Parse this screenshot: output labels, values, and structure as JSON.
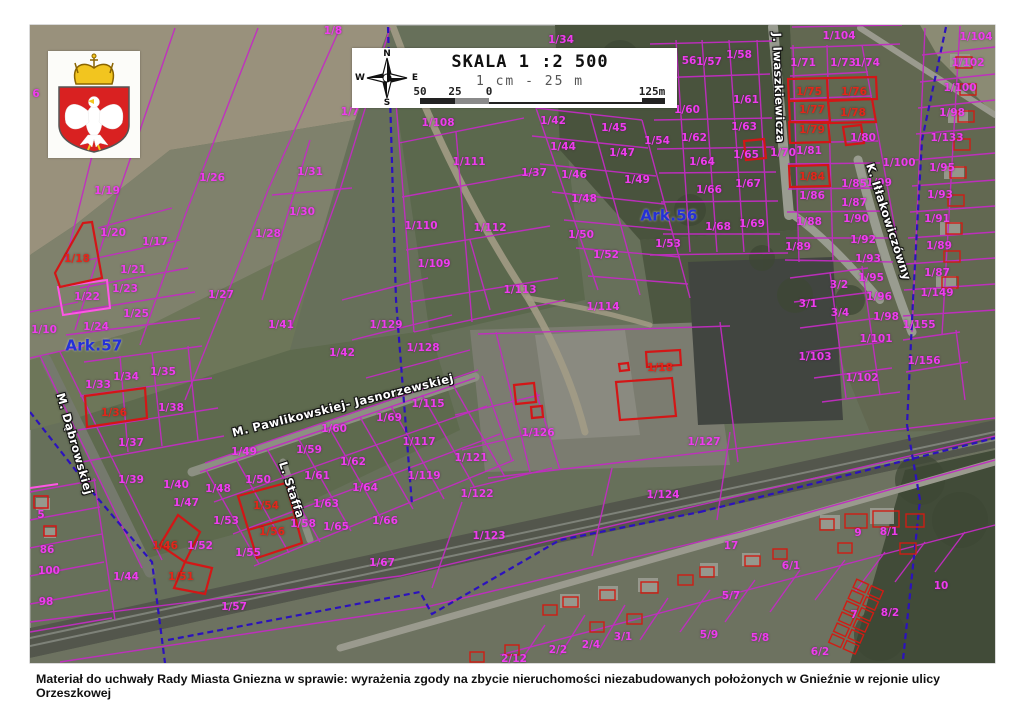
{
  "caption": "Materiał do uchwały Rady Miasta Gniezna w sprawie: wyrażenia zgody na zbycie nieruchomości niezabudowanych położonych w Gnieźnie w rejonie ulicy Orzeszkowej",
  "scale_box": {
    "title": "SKALA 1 :2 500",
    "subtitle": "1 cm - 25 m",
    "compass": {
      "n": "N",
      "e": "E",
      "s": "S",
      "w": "W"
    },
    "bar_labels": [
      {
        "t": "50",
        "x": 0
      },
      {
        "t": "25",
        "x": 35
      },
      {
        "t": "0",
        "x": 69
      },
      {
        "t": "125m",
        "x": 232
      }
    ]
  },
  "colors": {
    "parcel_line_magenta": "#c22cc2",
    "parcel_label_magenta": "#ee3cee",
    "highlight_red": "#d31616",
    "sheet_label_blue": "#2430d8",
    "sheet_boundary_blue": "#2c12bd"
  },
  "highlighted_parcels": [
    "1/18",
    "1/36",
    "1/46",
    "1/51",
    "1/54",
    "1/56",
    "1/75",
    "1/76",
    "1/77",
    "1/78",
    "1/79",
    "1/84"
  ],
  "map": {
    "sheets": [
      "Ark.57",
      "Ark.56"
    ],
    "streets": [
      "M. Dąbrowskiej",
      "M. Pawlikowskiej- Jasnorzewskiej",
      "L. Staffa",
      "J. Iwaszkiewicza",
      "K. Iłłakowiczówny"
    ],
    "labels": [
      {
        "t": "1/8",
        "x": 333,
        "y": 31
      },
      {
        "t": "6",
        "x": 36,
        "y": 94
      },
      {
        "t": "1/7",
        "x": 350,
        "y": 112
      },
      {
        "t": "1/19",
        "x": 107,
        "y": 191
      },
      {
        "t": "1/26",
        "x": 212,
        "y": 178
      },
      {
        "t": "1/31",
        "x": 310,
        "y": 172
      },
      {
        "t": "1/30",
        "x": 302,
        "y": 212
      },
      {
        "t": "1/28",
        "x": 268,
        "y": 234
      },
      {
        "t": "1/17",
        "x": 155,
        "y": 242
      },
      {
        "t": "1/20",
        "x": 113,
        "y": 233
      },
      {
        "t": "1/18",
        "x": 77,
        "y": 259,
        "c": "r"
      },
      {
        "t": "1/21",
        "x": 133,
        "y": 270
      },
      {
        "t": "1/23",
        "x": 125,
        "y": 289
      },
      {
        "t": "1/22",
        "x": 87,
        "y": 297
      },
      {
        "t": "1/27",
        "x": 221,
        "y": 295
      },
      {
        "t": "1/25",
        "x": 136,
        "y": 314
      },
      {
        "t": "1/24",
        "x": 96,
        "y": 327
      },
      {
        "t": "1/10",
        "x": 44,
        "y": 330
      },
      {
        "t": "Ark.57",
        "x": 94,
        "y": 346,
        "c": "b"
      },
      {
        "t": "1/33",
        "x": 98,
        "y": 385
      },
      {
        "t": "1/34",
        "x": 126,
        "y": 377
      },
      {
        "t": "1/35",
        "x": 163,
        "y": 372
      },
      {
        "t": "1/36",
        "x": 114,
        "y": 413,
        "c": "r"
      },
      {
        "t": "1/38",
        "x": 171,
        "y": 408
      },
      {
        "t": "1/37",
        "x": 131,
        "y": 443
      },
      {
        "t": "1/41",
        "x": 281,
        "y": 325
      },
      {
        "t": "1/42",
        "x": 342,
        "y": 353
      },
      {
        "t": "1/39",
        "x": 131,
        "y": 480
      },
      {
        "t": "1/40",
        "x": 176,
        "y": 485
      },
      {
        "t": "1/49",
        "x": 244,
        "y": 452
      },
      {
        "t": "1/48",
        "x": 218,
        "y": 489
      },
      {
        "t": "1/50",
        "x": 258,
        "y": 480
      },
      {
        "t": "1/53",
        "x": 226,
        "y": 521
      },
      {
        "t": "1/54",
        "x": 266,
        "y": 506,
        "c": "r"
      },
      {
        "t": "1/56",
        "x": 272,
        "y": 532,
        "c": "r"
      },
      {
        "t": "1/55",
        "x": 248,
        "y": 553
      },
      {
        "t": "1/58",
        "x": 303,
        "y": 524
      },
      {
        "t": "1/59",
        "x": 309,
        "y": 450
      },
      {
        "t": "1/60",
        "x": 334,
        "y": 429
      },
      {
        "t": "1/61",
        "x": 317,
        "y": 476
      },
      {
        "t": "1/62",
        "x": 353,
        "y": 462
      },
      {
        "t": "1/63",
        "x": 326,
        "y": 504
      },
      {
        "t": "1/64",
        "x": 365,
        "y": 488
      },
      {
        "t": "1/65",
        "x": 336,
        "y": 527
      },
      {
        "t": "1/66",
        "x": 385,
        "y": 521
      },
      {
        "t": "1/67",
        "x": 382,
        "y": 563
      },
      {
        "t": "1/69",
        "x": 389,
        "y": 418
      },
      {
        "t": "1/115",
        "x": 428,
        "y": 404
      },
      {
        "t": "1/117",
        "x": 419,
        "y": 442
      },
      {
        "t": "1/119",
        "x": 424,
        "y": 476
      },
      {
        "t": "1/121",
        "x": 471,
        "y": 458
      },
      {
        "t": "1/122",
        "x": 477,
        "y": 494
      },
      {
        "t": "1/129",
        "x": 386,
        "y": 325
      },
      {
        "t": "1/128",
        "x": 423,
        "y": 348
      },
      {
        "t": "5",
        "x": 41,
        "y": 515
      },
      {
        "t": "86",
        "x": 47,
        "y": 550
      },
      {
        "t": "100",
        "x": 49,
        "y": 571
      },
      {
        "t": "98",
        "x": 46,
        "y": 602
      },
      {
        "t": "1/44",
        "x": 126,
        "y": 577
      },
      {
        "t": "1/47",
        "x": 186,
        "y": 503
      },
      {
        "t": "1/46",
        "x": 165,
        "y": 546,
        "c": "r"
      },
      {
        "t": "1/52",
        "x": 200,
        "y": 546
      },
      {
        "t": "1/51",
        "x": 181,
        "y": 577,
        "c": "r"
      },
      {
        "t": "1/57",
        "x": 234,
        "y": 607
      },
      {
        "t": "1/34",
        "x": 561,
        "y": 40
      },
      {
        "t": "1/108",
        "x": 438,
        "y": 123
      },
      {
        "t": "1/42",
        "x": 553,
        "y": 121
      },
      {
        "t": "1/45",
        "x": 614,
        "y": 128
      },
      {
        "t": "1/111",
        "x": 469,
        "y": 162
      },
      {
        "t": "1/44",
        "x": 563,
        "y": 147
      },
      {
        "t": "1/47",
        "x": 622,
        "y": 153
      },
      {
        "t": "1/37",
        "x": 534,
        "y": 173
      },
      {
        "t": "1/46",
        "x": 574,
        "y": 175
      },
      {
        "t": "1/49",
        "x": 637,
        "y": 180
      },
      {
        "t": "1/110",
        "x": 421,
        "y": 226
      },
      {
        "t": "1/48",
        "x": 584,
        "y": 199
      },
      {
        "t": "1/112",
        "x": 490,
        "y": 228
      },
      {
        "t": "1/50",
        "x": 581,
        "y": 235
      },
      {
        "t": "1/109",
        "x": 434,
        "y": 264
      },
      {
        "t": "1/52",
        "x": 606,
        "y": 255
      },
      {
        "t": "1/113",
        "x": 520,
        "y": 290
      },
      {
        "t": "1/114",
        "x": 603,
        "y": 307
      },
      {
        "t": "Ark.56",
        "x": 669,
        "y": 216,
        "c": "b"
      },
      {
        "t": "56",
        "x": 689,
        "y": 61
      },
      {
        "t": "1/57",
        "x": 709,
        "y": 62
      },
      {
        "t": "1/58",
        "x": 739,
        "y": 55
      },
      {
        "t": "1/61",
        "x": 746,
        "y": 100
      },
      {
        "t": "1/60",
        "x": 687,
        "y": 110
      },
      {
        "t": "1/63",
        "x": 744,
        "y": 127
      },
      {
        "t": "1/62",
        "x": 694,
        "y": 138
      },
      {
        "t": "1/54",
        "x": 657,
        "y": 141
      },
      {
        "t": "1/65",
        "x": 746,
        "y": 155
      },
      {
        "t": "1/64",
        "x": 702,
        "y": 162
      },
      {
        "t": "1/67",
        "x": 748,
        "y": 184
      },
      {
        "t": "1/66",
        "x": 709,
        "y": 190
      },
      {
        "t": "1/53",
        "x": 668,
        "y": 244
      },
      {
        "t": "1/68",
        "x": 718,
        "y": 227
      },
      {
        "t": "1/69",
        "x": 752,
        "y": 224
      },
      {
        "t": "1/70",
        "x": 783,
        "y": 153
      },
      {
        "t": "1/104",
        "x": 839,
        "y": 36
      },
      {
        "t": "1/71",
        "x": 803,
        "y": 63
      },
      {
        "t": "1/73",
        "x": 843,
        "y": 63
      },
      {
        "t": "1/74",
        "x": 867,
        "y": 63
      },
      {
        "t": "1/75",
        "x": 809,
        "y": 92,
        "c": "r"
      },
      {
        "t": "1/76",
        "x": 854,
        "y": 92,
        "c": "r"
      },
      {
        "t": "1/77",
        "x": 812,
        "y": 110,
        "c": "r"
      },
      {
        "t": "1/78",
        "x": 853,
        "y": 113,
        "c": "r"
      },
      {
        "t": "1/79",
        "x": 812,
        "y": 130,
        "c": "r"
      },
      {
        "t": "1/80",
        "x": 863,
        "y": 138
      },
      {
        "t": "1/81",
        "x": 809,
        "y": 151
      },
      {
        "t": "1/84",
        "x": 812,
        "y": 177,
        "c": "r"
      },
      {
        "t": "1/100",
        "x": 899,
        "y": 163
      },
      {
        "t": "1/99",
        "x": 879,
        "y": 183
      },
      {
        "t": "1/85",
        "x": 854,
        "y": 184
      },
      {
        "t": "1/86",
        "x": 812,
        "y": 196
      },
      {
        "t": "1/87",
        "x": 854,
        "y": 203
      },
      {
        "t": "1/88",
        "x": 809,
        "y": 222
      },
      {
        "t": "1/90",
        "x": 856,
        "y": 219
      },
      {
        "t": "1/89",
        "x": 798,
        "y": 247
      },
      {
        "t": "1/92",
        "x": 863,
        "y": 240
      },
      {
        "t": "1/93",
        "x": 868,
        "y": 259
      },
      {
        "t": "3/2",
        "x": 839,
        "y": 285
      },
      {
        "t": "1/95",
        "x": 871,
        "y": 278
      },
      {
        "t": "3/1",
        "x": 808,
        "y": 304
      },
      {
        "t": "1/96",
        "x": 879,
        "y": 297
      },
      {
        "t": "3/4",
        "x": 840,
        "y": 313
      },
      {
        "t": "1/98",
        "x": 886,
        "y": 317
      },
      {
        "t": "1/101",
        "x": 876,
        "y": 339
      },
      {
        "t": "1/103",
        "x": 815,
        "y": 357
      },
      {
        "t": "1/102",
        "x": 862,
        "y": 378
      },
      {
        "t": "1/104",
        "x": 976,
        "y": 37
      },
      {
        "t": "1/102",
        "x": 968,
        "y": 63
      },
      {
        "t": "1/100",
        "x": 960,
        "y": 88
      },
      {
        "t": "1/98",
        "x": 952,
        "y": 113
      },
      {
        "t": "1/133",
        "x": 947,
        "y": 138
      },
      {
        "t": "1/95",
        "x": 942,
        "y": 168
      },
      {
        "t": "1/93",
        "x": 940,
        "y": 195
      },
      {
        "t": "1/91",
        "x": 937,
        "y": 219
      },
      {
        "t": "1/89",
        "x": 939,
        "y": 246
      },
      {
        "t": "1/87",
        "x": 937,
        "y": 273
      },
      {
        "t": "1/149",
        "x": 937,
        "y": 293
      },
      {
        "t": "1/155",
        "x": 919,
        "y": 325
      },
      {
        "t": "1/156",
        "x": 924,
        "y": 361
      },
      {
        "t": "1/18",
        "x": 660,
        "y": 368,
        "c": "r"
      },
      {
        "t": "1/126",
        "x": 538,
        "y": 433
      },
      {
        "t": "1/127",
        "x": 704,
        "y": 442
      },
      {
        "t": "1/124",
        "x": 663,
        "y": 495
      },
      {
        "t": "1/123",
        "x": 489,
        "y": 536
      },
      {
        "t": "17",
        "x": 731,
        "y": 546
      },
      {
        "t": "5/7",
        "x": 731,
        "y": 596
      },
      {
        "t": "6/1",
        "x": 791,
        "y": 566
      },
      {
        "t": "9",
        "x": 858,
        "y": 533
      },
      {
        "t": "8/1",
        "x": 889,
        "y": 532
      },
      {
        "t": "5/9",
        "x": 709,
        "y": 635
      },
      {
        "t": "5/8",
        "x": 760,
        "y": 638
      },
      {
        "t": "10",
        "x": 941,
        "y": 586
      },
      {
        "t": "7",
        "x": 854,
        "y": 615
      },
      {
        "t": "8/2",
        "x": 890,
        "y": 613
      },
      {
        "t": "6/2",
        "x": 820,
        "y": 652
      },
      {
        "t": "3/1",
        "x": 623,
        "y": 637
      },
      {
        "t": "2/4",
        "x": 591,
        "y": 645
      },
      {
        "t": "2/2",
        "x": 558,
        "y": 650
      },
      {
        "t": "2/12",
        "x": 514,
        "y": 659
      },
      {
        "t": "M. Dąbrowskiej",
        "x": 74,
        "y": 444,
        "c": "s",
        "rot": 74
      },
      {
        "t": "M. Pawlikowskiej- Jasnorzewskiej",
        "x": 343,
        "y": 406,
        "c": "s",
        "rot": -14
      },
      {
        "t": "L. Staffa",
        "x": 291,
        "y": 490,
        "c": "s",
        "rot": 72
      },
      {
        "t": "J. Iwaszkiewicza",
        "x": 778,
        "y": 88,
        "c": "s",
        "rot": 88
      },
      {
        "t": "K. Iłłakowiczówny",
        "x": 888,
        "y": 222,
        "c": "s",
        "rot": 72
      }
    ]
  }
}
